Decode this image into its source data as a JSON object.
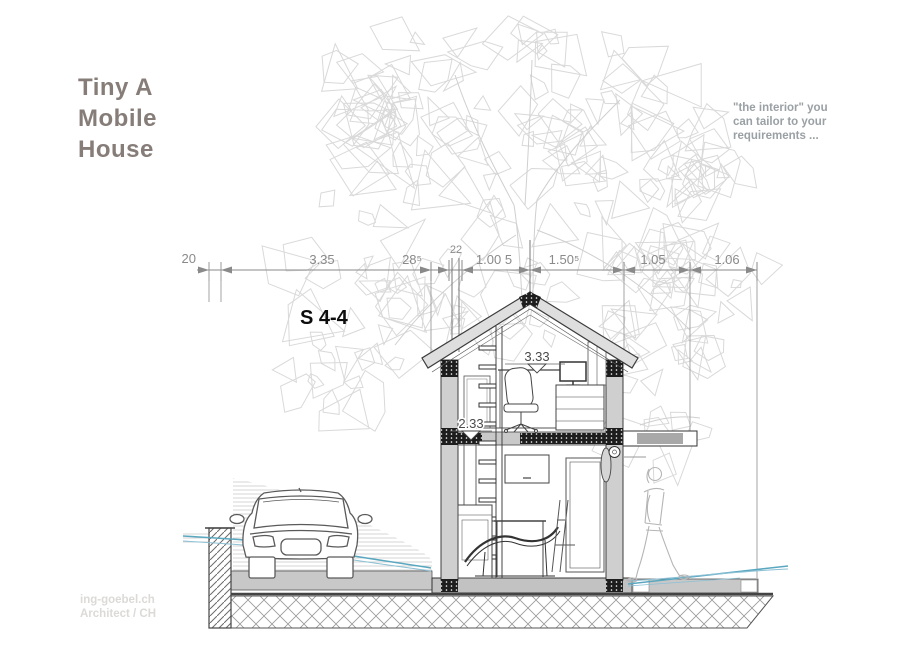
{
  "title": {
    "lines": [
      "Tiny A",
      "Mobile",
      "House"
    ]
  },
  "tagline": {
    "lines": [
      "\"the interior\" you",
      "can tailor to your",
      "requirements ..."
    ]
  },
  "section_label": "S 4-4",
  "dimensions": {
    "horizontal": [
      "20",
      "3.35",
      "28⁵",
      "22",
      "1.00 5",
      "1.50⁵",
      "1.05",
      "1.06"
    ],
    "interior": [
      "3.33",
      "2.33"
    ]
  },
  "watermark": {
    "lines": [
      "ing-goebel.ch",
      "Architect / CH"
    ]
  },
  "colors": {
    "title_text": "#867d79",
    "tagline_text": "#9aa0a4",
    "sketch_gray": "#d9d9d9",
    "dimension_gray": "#8a8a8a",
    "terrain_blue": "#5aa7c0",
    "watermark_text": "#dcdad7",
    "line_dark": "#3c3c3c"
  }
}
